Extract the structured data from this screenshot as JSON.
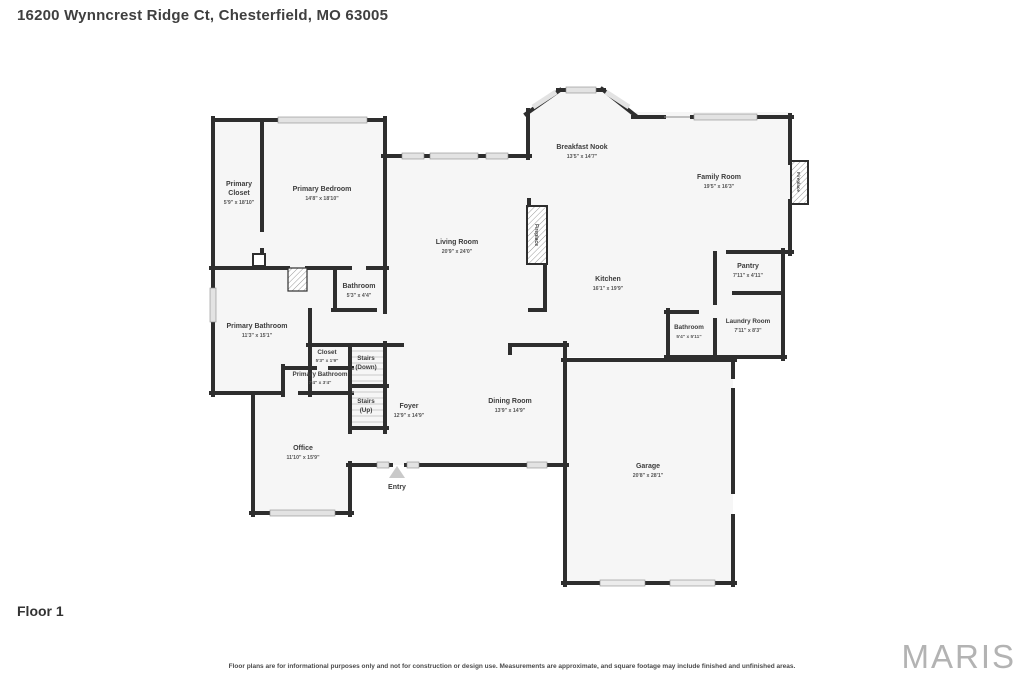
{
  "header": {
    "title": "16200 Wynncrest Ridge Ct, Chesterfield, MO 63005"
  },
  "footer": {
    "floor_label": "Floor 1",
    "disclaimer": "Floor plans are for informational purposes only and not for construction or design use. Measurements are approximate, and square footage may include finished and unfinished areas.",
    "watermark": "MARIS"
  },
  "colors": {
    "wall": "#2e2e2e",
    "room_fill": "#f6f6f6",
    "window_fill": "#e3e3e3",
    "label_text": "#3d3d3d",
    "watermark": "#b3b3b3"
  },
  "rooms": {
    "primary_closet": {
      "name_line1": "Primary",
      "name_line2": "Closet",
      "dims": "5'9\" x 18'10\""
    },
    "primary_bedroom": {
      "name": "Primary Bedroom",
      "dims": "14'8\" x 18'10\""
    },
    "breakfast_nook": {
      "name": "Breakfast Nook",
      "dims": "13'5\" x 14'7\""
    },
    "family_room": {
      "name": "Family Room",
      "dims": "19'5\" x 16'3\""
    },
    "living_room": {
      "name": "Living Room",
      "dims": "20'9\" x 24'0\""
    },
    "kitchen": {
      "name": "Kitchen",
      "dims": "16'1\" x 19'9\""
    },
    "pantry": {
      "name": "Pantry",
      "dims": "7'11\" x 4'11\""
    },
    "laundry_room": {
      "name": "Laundry Room",
      "dims": "7'11\" x 8'3\""
    },
    "bathroom_hall": {
      "name": "Bathroom",
      "dims": "5'4\" x 5'11\""
    },
    "bathroom_upper": {
      "name": "Bathroom",
      "dims": "5'3\" x 4'4\""
    },
    "primary_bathroom": {
      "name": "Primary Bathroom",
      "dims": "11'3\" x 15'1\""
    },
    "closet": {
      "name": "Closet",
      "dims": "5'3\" x 1'9\""
    },
    "stairs_down": {
      "line1": "Stairs",
      "line2": "(Down)"
    },
    "primary_bathroom_2": {
      "name": "Primary Bathroom",
      "dims": "7'4\" x 3'4\""
    },
    "stairs_up": {
      "line1": "Stairs",
      "line2": "(Up)"
    },
    "foyer": {
      "name": "Foyer",
      "dims": "12'9\" x 14'9\""
    },
    "dining_room": {
      "name": "Dining Room",
      "dims": "13'9\" x 14'9\""
    },
    "office": {
      "name": "Office",
      "dims": "11'10\" x 15'9\""
    },
    "garage": {
      "name": "Garage",
      "dims": "20'8\" x 28'1\""
    },
    "entry": {
      "name": "Entry"
    },
    "fireplace": {
      "label": "Fireplace"
    }
  }
}
